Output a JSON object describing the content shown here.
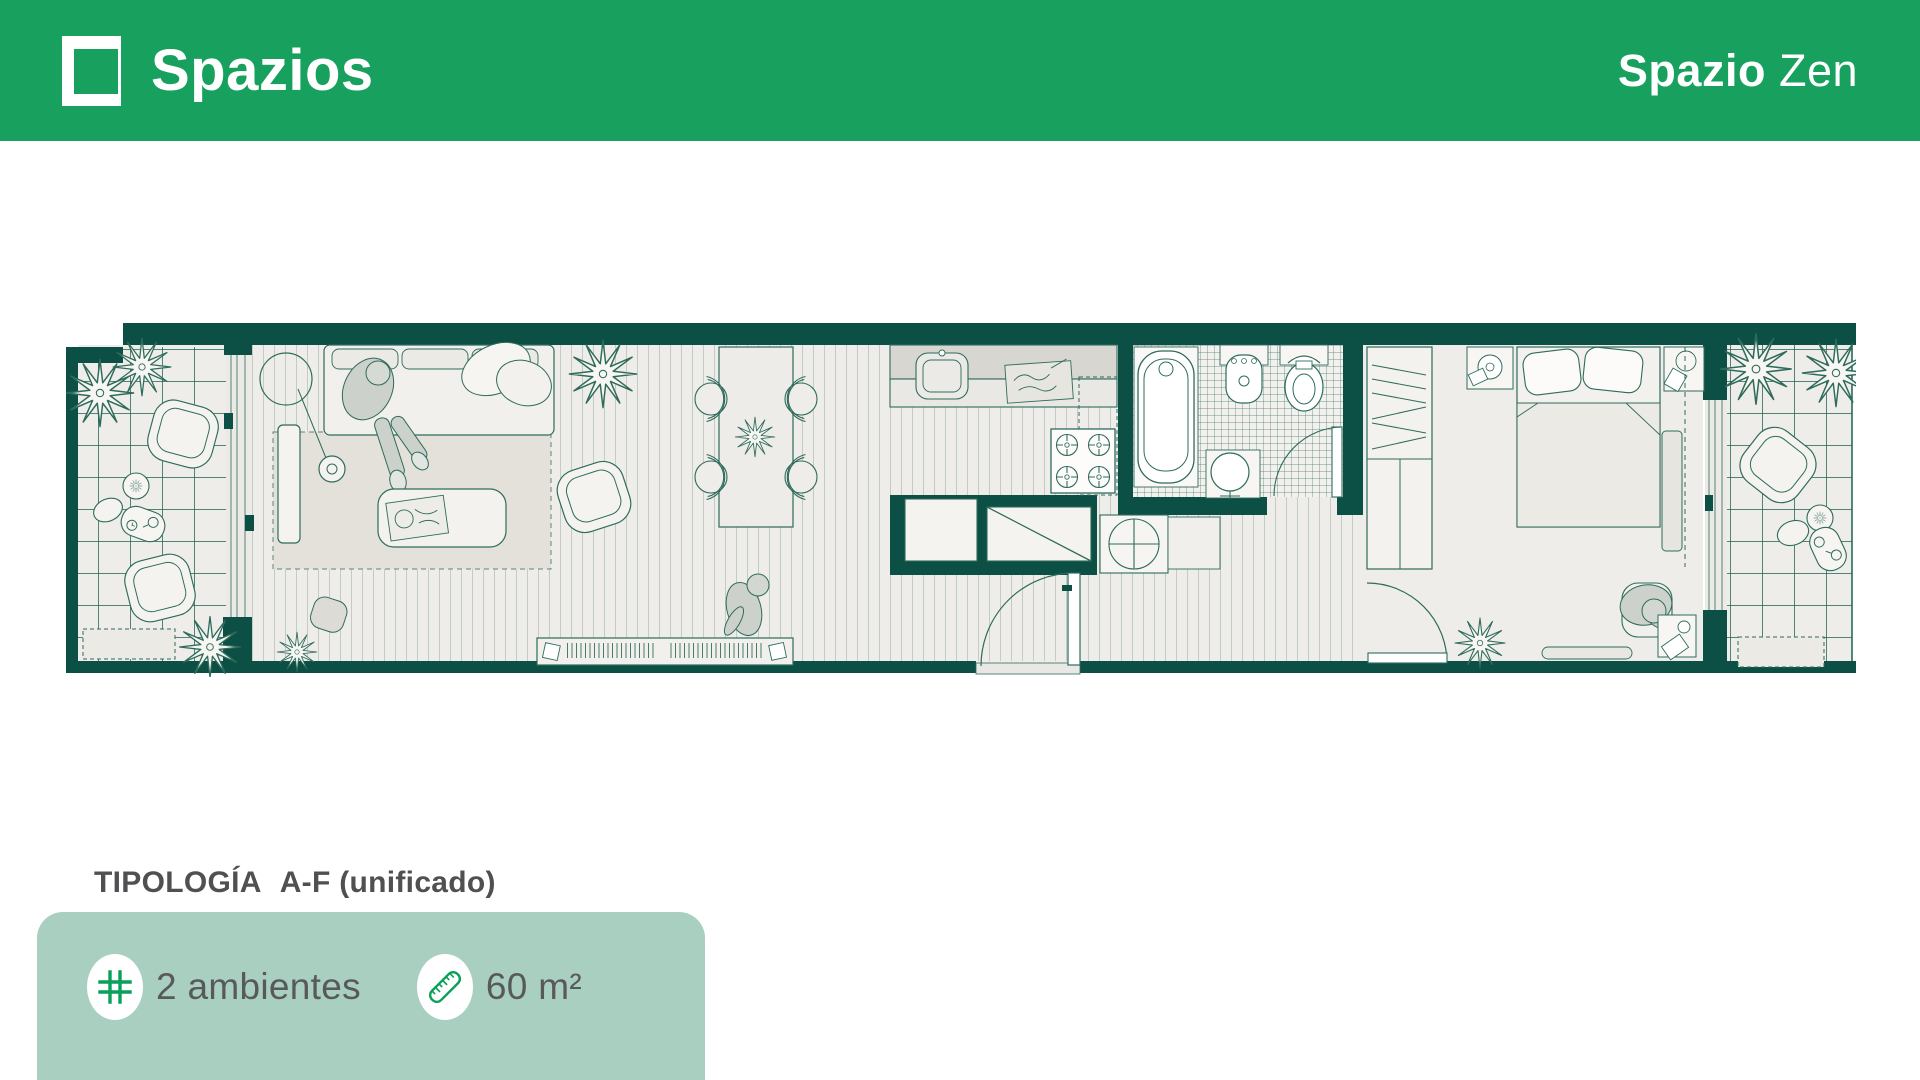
{
  "header": {
    "brand": "Spazios",
    "project_bold": "Spazio",
    "project_light": "Zen"
  },
  "typology": {
    "label": "TIPOLOGÍA",
    "value": "A-F (unificado)"
  },
  "features": {
    "rooms": {
      "icon": "grid-icon",
      "label": "2 ambientes"
    },
    "area": {
      "icon": "ruler-icon",
      "label": "60 m²"
    }
  },
  "colors": {
    "brand_green": "#18a15e",
    "icon_green": "#0aa05c",
    "card_bg": "#a9cfc0",
    "plan_wall": "#0c4f44",
    "plan_line": "#2f6b5c",
    "text_dark": "#4f5052",
    "text_gray": "#58595b"
  }
}
